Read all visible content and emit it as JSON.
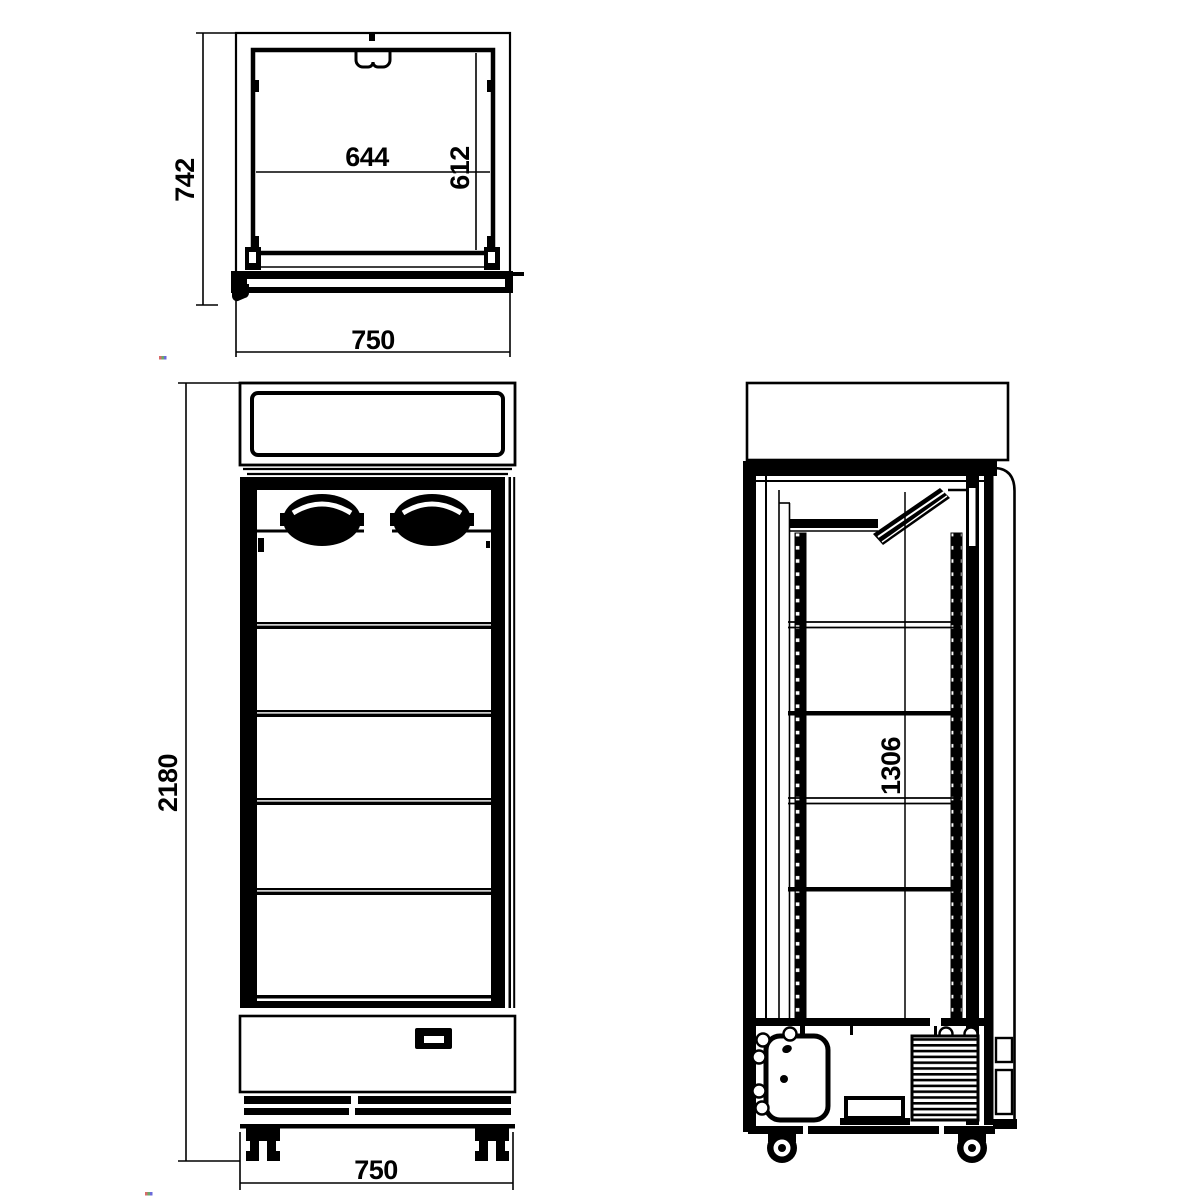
{
  "drawing": {
    "top_view": {
      "overall_depth": "742",
      "inner_width": "644",
      "inner_depth": "612",
      "overall_width": "750"
    },
    "front_view": {
      "overall_height": "2180",
      "overall_width": "750"
    },
    "side_view": {
      "shelf_area_height": "1306"
    }
  }
}
